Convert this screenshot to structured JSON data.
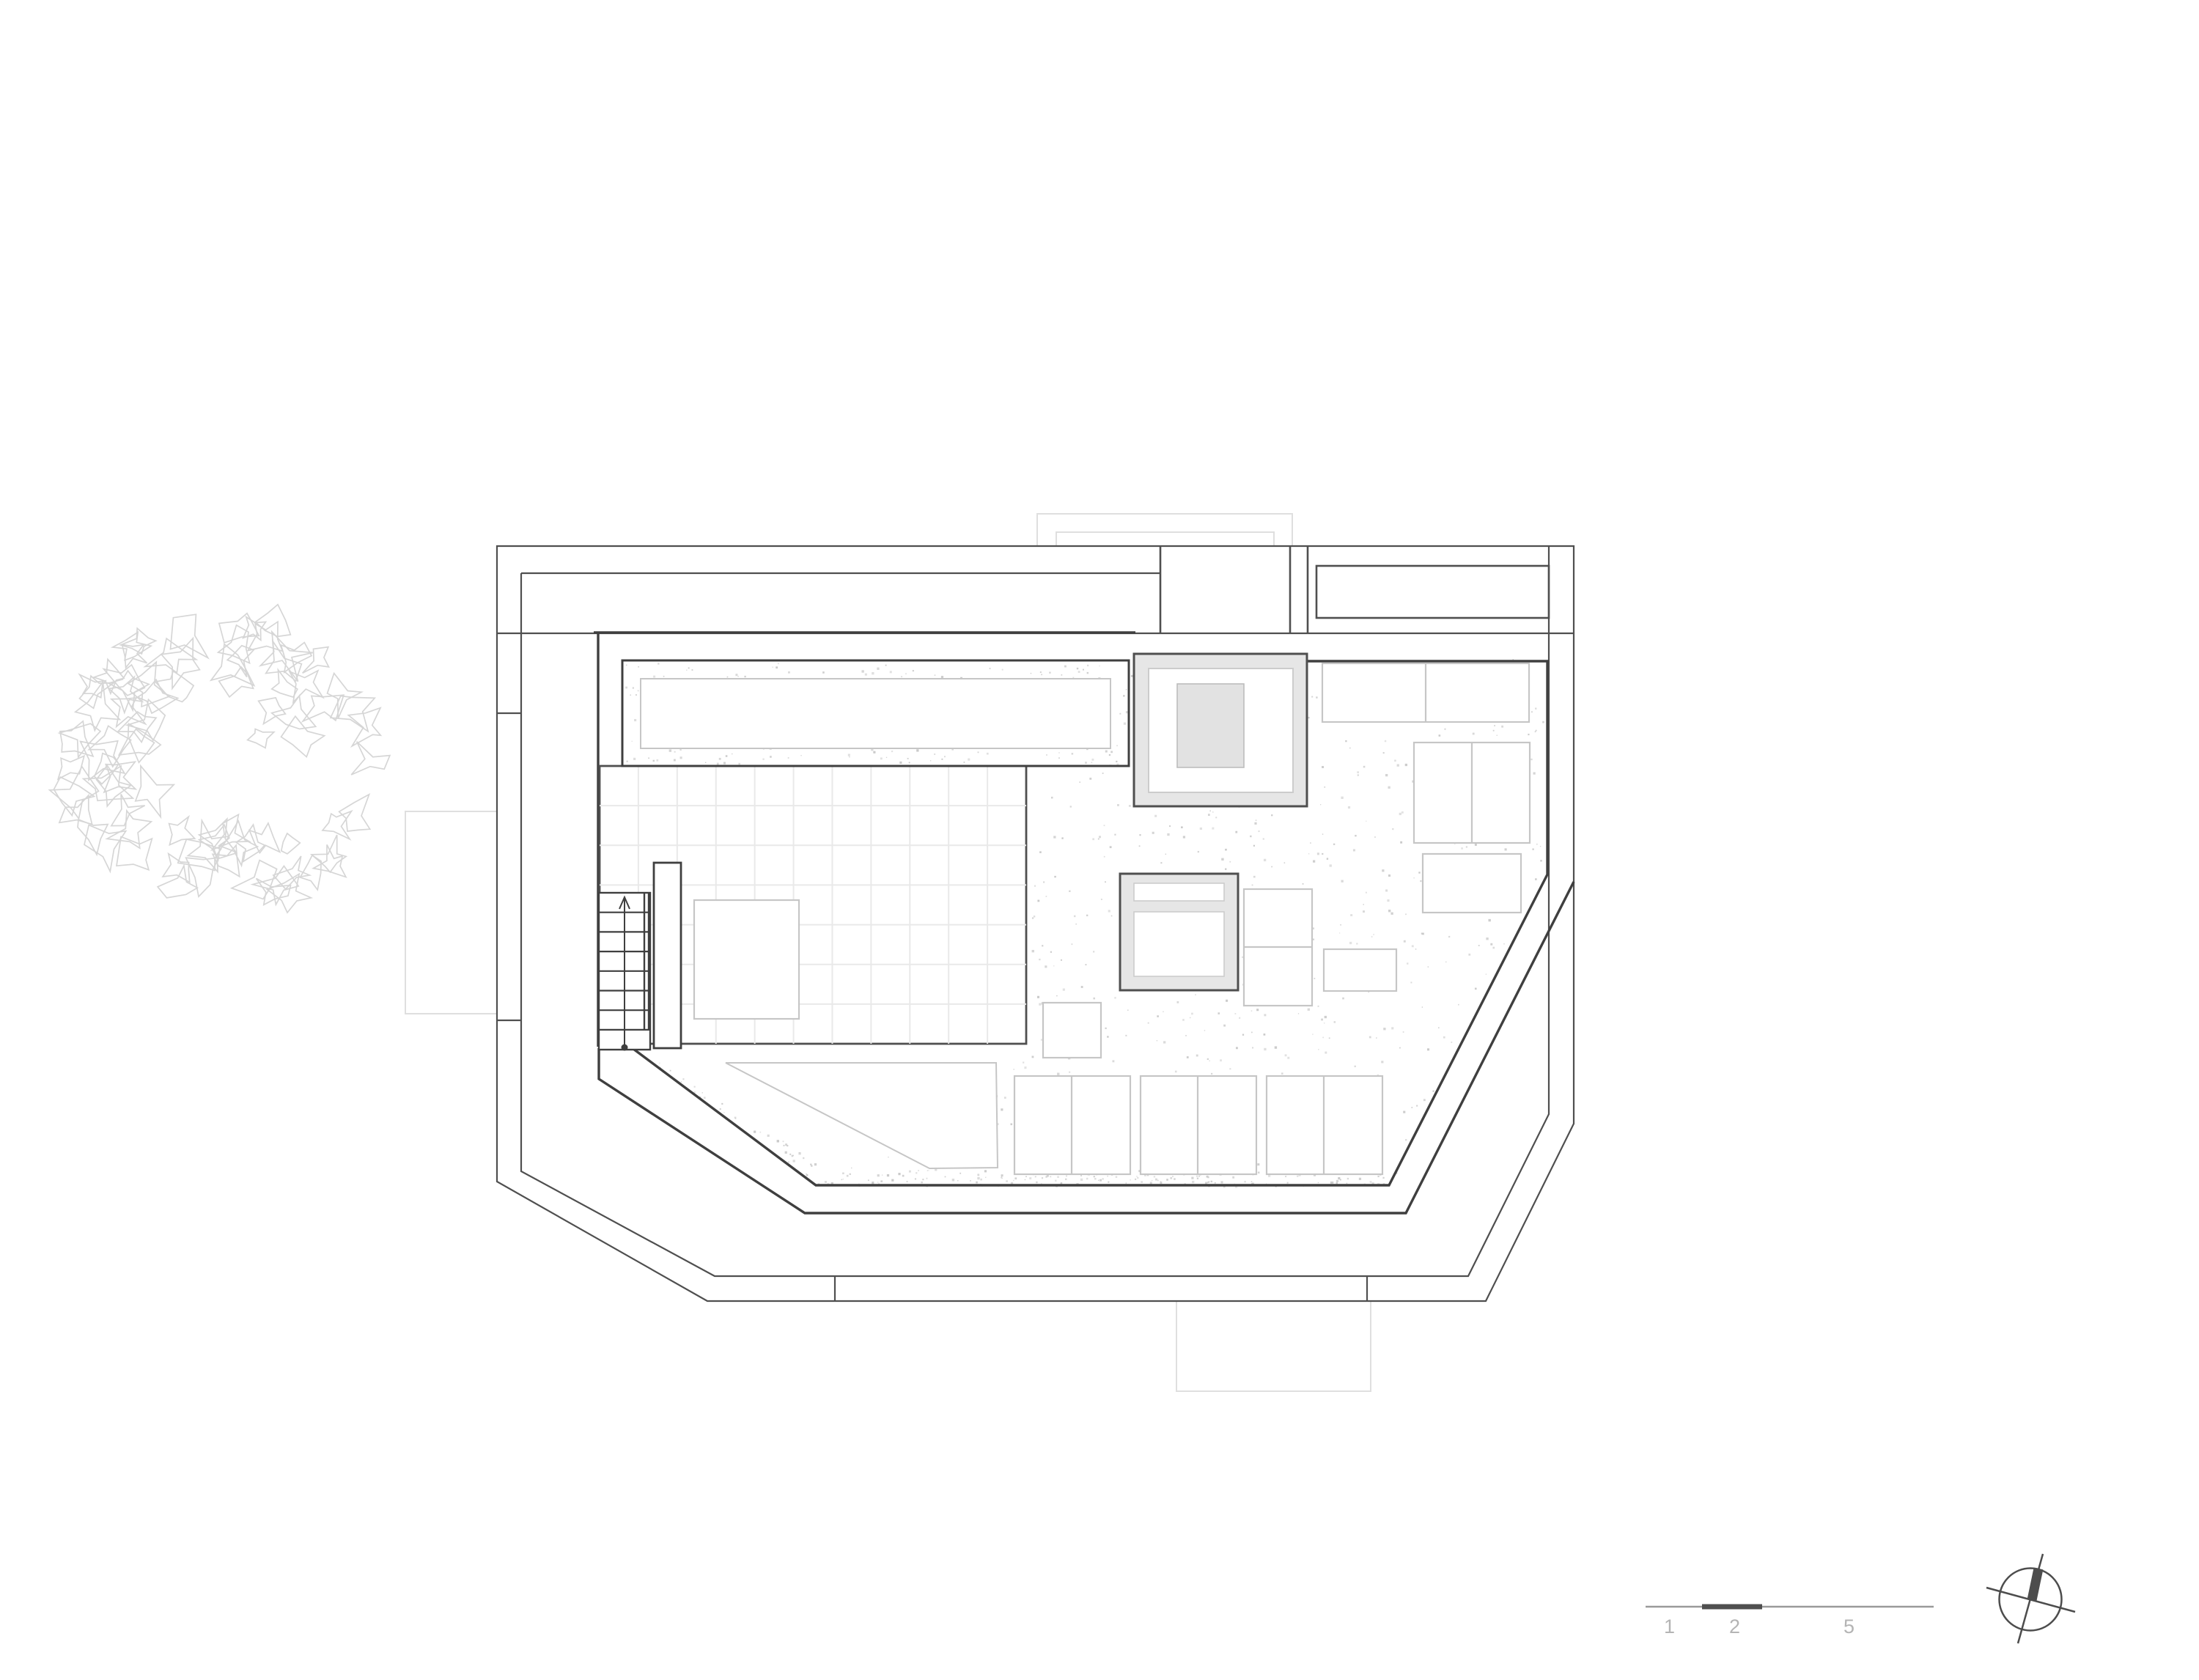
{
  "drawing": {
    "type": "architectural-roof-plan",
    "visible_text_note": "drawing contains no text except scale bar numbers"
  },
  "scale_bar": {
    "labels": [
      "1",
      "2",
      "5"
    ]
  },
  "colors": {
    "line_dark": "#4f4f4f",
    "line_wall": "#3f3f3f",
    "line_faint": "#dfdfdf",
    "line_furniture": "#c6c6c6",
    "line_grid": "#e9e9e9",
    "fill_skylight": "#e6e6e6",
    "fill_skylight_center": "#e2e2e2",
    "stipple": "#c9c9c9",
    "tree_line": "#d6d6d6",
    "scale_line": "#9a9a9a",
    "scale_segment": "#4f4f4f",
    "scale_text": "#b4b4b4",
    "compass_line": "#4d4d4d"
  }
}
